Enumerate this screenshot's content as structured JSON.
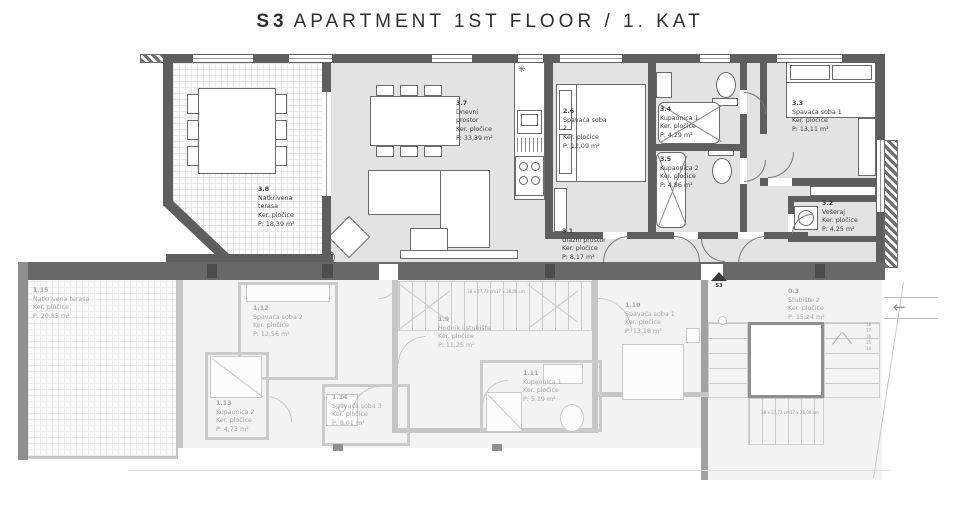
{
  "title": {
    "unit": "S3",
    "text": "APARTMENT 1ST FLOOR / 1. KAT"
  },
  "apartment_rooms": [
    {
      "id": "3.8",
      "name": "Natkrivena terasa",
      "floor": "Ker. pločice",
      "area": "P: 18,39 m²"
    },
    {
      "id": "3.7",
      "name": "Dnevni prostor",
      "floor": "Ker. pločice",
      "area": "P: 33,39 m²"
    },
    {
      "id": "2.6",
      "name": "Spavaća soba 2",
      "floor": "Ker. pločice",
      "area": "P: 12,09 m²"
    },
    {
      "id": "3.4",
      "name": "Kupaonica 1",
      "floor": "Ker. pločice",
      "area": "P: 4,29 m²"
    },
    {
      "id": "3.5",
      "name": "Kupaonica 2",
      "floor": "Ker. pločice",
      "area": "P: 4,86 m²"
    },
    {
      "id": "3.3",
      "name": "Spavaća soba 1",
      "floor": "Ker. pločice",
      "area": "P: 13,11 m²"
    },
    {
      "id": "3.2",
      "name": "Vešeraj",
      "floor": "Ker. pločice",
      "area": "P: 4,25 m²"
    },
    {
      "id": "3.1",
      "name": "Ulazni prostor",
      "floor": "Ker. pločice",
      "area": "P: 8,17 m²"
    }
  ],
  "lower_rooms": [
    {
      "id": "1.15",
      "name": "Natkrivena terasa",
      "floor": "Ker. pločice",
      "area": "P: 20,85 m²"
    },
    {
      "id": "1.12",
      "name": "Spavaća soba 2",
      "floor": "Ker. pločice",
      "area": "P: 12,56 m²"
    },
    {
      "id": "1.9",
      "name": "Hodnik i stubište",
      "floor": "Ker. pločice",
      "area": "P: 11,25 m²"
    },
    {
      "id": "1.10",
      "name": "Spavaća soba 1",
      "floor": "Ker. pločice",
      "area": "P: 13,18 m²"
    },
    {
      "id": "1.11",
      "name": "Kupaonica 1",
      "floor": "Ker. pločice",
      "area": "P: 5,19 m²"
    },
    {
      "id": "1.13",
      "name": "Kupaonica 2",
      "floor": "Ker. pločice",
      "area": "P: 4,73 m²"
    },
    {
      "id": "1.14",
      "name": "Spavaća soba 3",
      "floor": "Ker. pločice",
      "area": "P: 8,01 m²"
    },
    {
      "id": "0.3",
      "name": "Stubište 2",
      "floor": "Ker. pločice",
      "area": "P: 15,24 m²"
    }
  ],
  "markers": {
    "entrance_label": "S3",
    "stair_note_line1": "38 x 27,72 cm",
    "stair_note_line2": "17 x 28,00 cm",
    "stair_numbers": "18\n17\n16\n15\n14",
    "symbols": {
      "kitchen_star": "✳",
      "direction_arrow": "←"
    }
  },
  "colors": {
    "wall": "#5e5e5e",
    "room_fill": "#e3e3e3",
    "lower_wall": "#c6c6c6",
    "text": "#3f3f3f",
    "lower_text": "#a8a8a8",
    "background": "#ffffff"
  }
}
